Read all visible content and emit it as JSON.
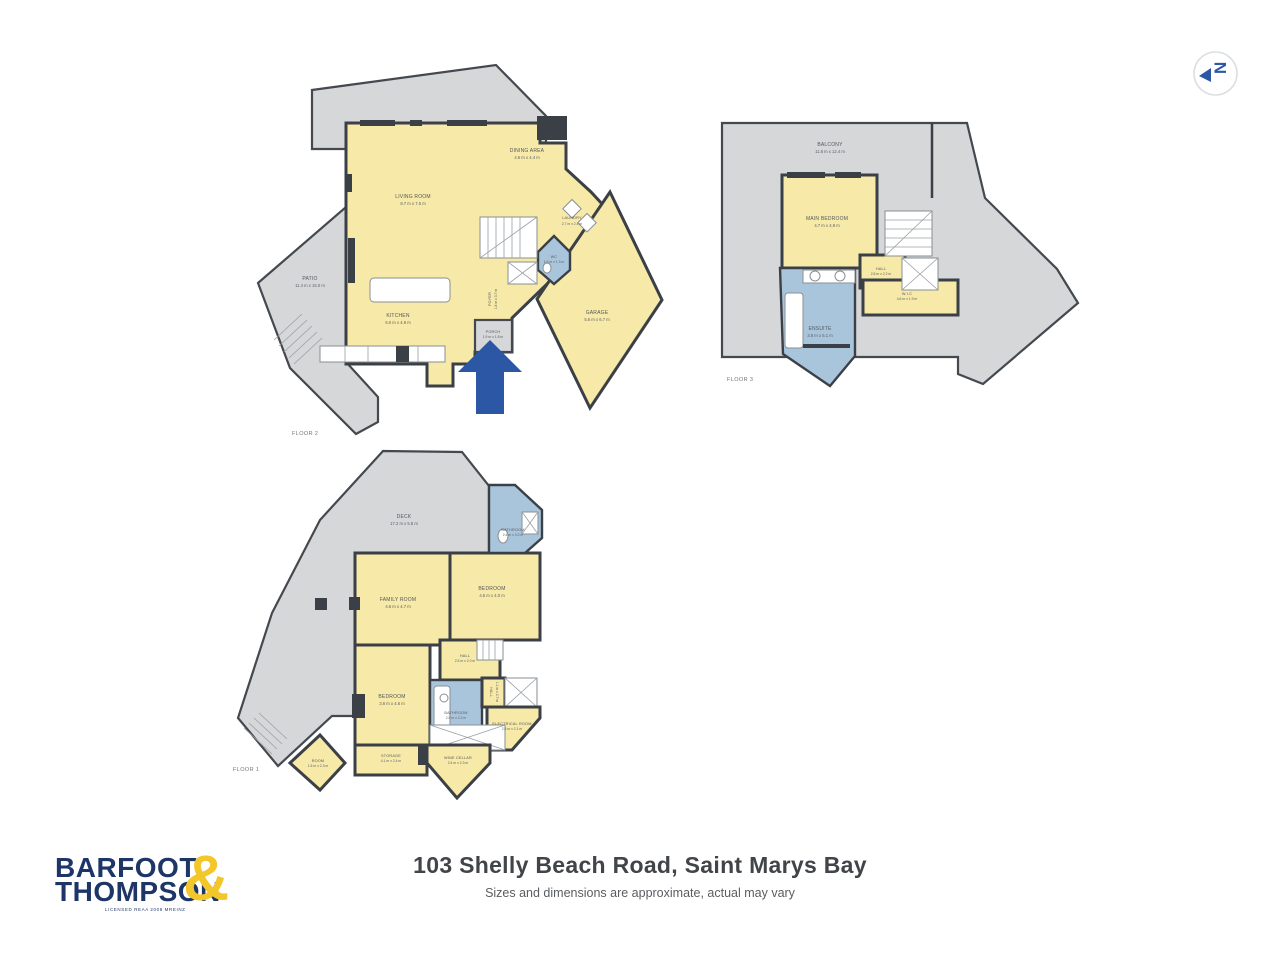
{
  "meta": {
    "sheet_kind": "real-estate floor plan",
    "colors": {
      "room_yellow": "#f7e9a8",
      "outdoor_gray": "#d5d7d9",
      "wet_area_blue": "#a9c5dc",
      "wall_dark": "#3b4046",
      "arrow_blue": "#2b57a5",
      "logo_navy": "#1e3667",
      "logo_yellow": "#f3c62a"
    }
  },
  "compass": {
    "icon": "north-arrow",
    "letter": "N"
  },
  "floors": {
    "floor2": {
      "label": "FLOOR 2",
      "rooms": {
        "living": {
          "name": "LIVING ROOM",
          "dims": "8.7 m x 7.5 m"
        },
        "dining": {
          "name": "DINING AREA",
          "dims": "4.6 m x 4.4 m"
        },
        "kitchen": {
          "name": "KITCHEN",
          "dims": "6.0 m x 4.9 m"
        },
        "patio": {
          "name": "PATIO",
          "dims": "11.4 m x 15.0 m"
        },
        "laundry": {
          "name": "LAUNDRY",
          "dims": "2.7 m x 2.4 m"
        },
        "wc": {
          "name": "WC",
          "dims": "1.6 m x 1.3 m"
        },
        "foyer": {
          "name": "FOYER",
          "dims": "1.8 m x 3.7 m"
        },
        "porch": {
          "name": "PORCH",
          "dims": "1.9 m x 1.8 m"
        },
        "garage": {
          "name": "GARAGE",
          "dims": "5.6 m x 6.7 m"
        }
      }
    },
    "floor3": {
      "label": "FLOOR 3",
      "rooms": {
        "balcony": {
          "name": "BALCONY",
          "dims": "11.8 m x 12.4 m"
        },
        "main_bedroom": {
          "name": "MAIN BEDROOM",
          "dims": "4.7 m x 4.8 m"
        },
        "hall": {
          "name": "HALL",
          "dims": "2.8 m x 2.2 m"
        },
        "wic": {
          "name": "W.I.C",
          "dims": "4.6 m x 1.9 m"
        },
        "ensuite": {
          "name": "ENSUITE",
          "dims": "3.8 m x 5.1 m"
        }
      }
    },
    "floor1": {
      "label": "FLOOR 1",
      "rooms": {
        "deck": {
          "name": "DECK",
          "dims": "17.2 m x 5.8 m"
        },
        "family": {
          "name": "FAMILY ROOM",
          "dims": "4.6 m x 4.7 m"
        },
        "bedroom_top": {
          "name": "BEDROOM",
          "dims": "4.5 m x 4.0 m"
        },
        "bathroom_top": {
          "name": "BATHROOM",
          "dims": "2.4 m x 3.0 m"
        },
        "hall": {
          "name": "HALL",
          "dims": "2.5 m x 2.0 m"
        },
        "bedroom_lower": {
          "name": "BEDROOM",
          "dims": "3.6 m x 4.6 m"
        },
        "bathroom_lower": {
          "name": "BATHROOM",
          "dims": "2.5 m x 2.2 m"
        },
        "hall_small": {
          "name": "HALL",
          "dims": "1.1 m x 2.7 m"
        },
        "electrical": {
          "name": "ELECTRICAL ROOM",
          "dims": "2.5 m x 2.1 m"
        },
        "storage": {
          "name": "STORAGE",
          "dims": "4.1 m x 2.4 m"
        },
        "room": {
          "name": "ROOM",
          "dims": "1.5 m x 2.3 m"
        },
        "wine_cellar": {
          "name": "WINE CELLAR",
          "dims": "2.4 m x 2.3 m"
        }
      }
    }
  },
  "footer": {
    "title": "103 Shelly Beach Road, Saint Marys Bay",
    "subtitle": "Sizes and dimensions are approximate, actual may vary"
  },
  "logo": {
    "line1": "BARFOOT",
    "line2": "THOMPSON",
    "ampersand": "&",
    "caption": "LICENSED REAA 2008 MREINZ"
  }
}
